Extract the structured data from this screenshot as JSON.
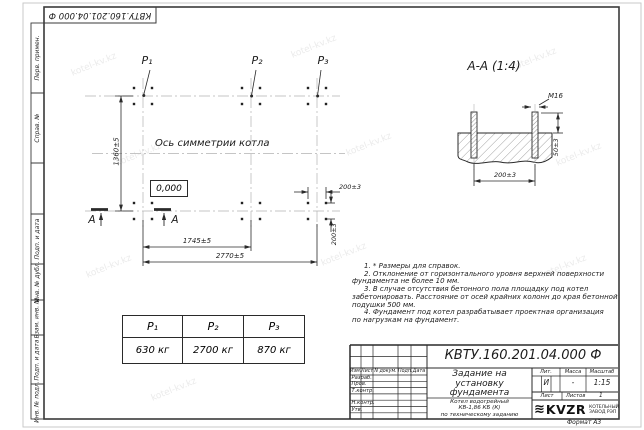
{
  "watermark": {
    "text": "kotel-kv.kz"
  },
  "corner_stamp": {
    "doc_number": "КВТУ.160.201.04.000 Ф"
  },
  "margin_fields": {
    "perv_primen": "Перв. примен.",
    "sprav_no": "Справ. №",
    "podp_data_1": "Подп. и дата",
    "inv_dubl": "Инв. № дубл.",
    "vzam_inv": "Взам. инв. №",
    "podp_data_2": "Подп. и дата",
    "inv_podl": "Инв. № подл."
  },
  "plan": {
    "load_labels": [
      "P₁",
      "P₂",
      "P₃"
    ],
    "symmetry_axis_label": "Ось симметрии котла",
    "elevation_mark": "0,000",
    "dim_height": "1360±5",
    "dim_span_p1_p2": "1745±5",
    "dim_span_total": "2770±5",
    "dim_bolt_spacing_h": "200±3",
    "dim_bolt_spacing_v": "200±3",
    "section_mark": "А"
  },
  "section": {
    "title": "А-А (1:4)",
    "bolt_thread": "M16",
    "dim_protrusion": "50±3",
    "dim_bolt_spacing": "200±3"
  },
  "loads_table": {
    "headers": [
      "P₁",
      "P₂",
      "P₃"
    ],
    "values": [
      "630 кг",
      "2700 кг",
      "870 кг"
    ]
  },
  "notes": {
    "lines": [
      "1. * Размеры для справок.",
      "2. Отклонение от горизонтального уровня верхней поверхности",
      "фундамента не более 10 мм.",
      "3. В случае отсутствия бетонного пола площадку под котел",
      "забетонировать. Расстояние от осей крайних колонн до края бетонной",
      "подушки 500 мм.",
      "4. Фундамент под котел разрабатывает проектная организация",
      "по нагрузкам на фундамент."
    ]
  },
  "title_block": {
    "doc_number": "КВТУ.160.201.04.000 Ф",
    "title_lines": [
      "Задание на",
      "установку",
      "фундамента"
    ],
    "product_lines": [
      "Котел водогрейный",
      "КВ-1,86 КБ (К)",
      "по техническому заданию"
    ],
    "rev_header": {
      "izm": "Изм.",
      "list": "Лист",
      "doc": "N докум.",
      "podp": "Подп.",
      "data": "Дата"
    },
    "staff_rows": [
      "Разраб.",
      "Пров.",
      "Т.контр.",
      "",
      "Н.контр.",
      "Утв."
    ],
    "lit_header": "Лит.",
    "mass_header": "Масса",
    "scale_header": "Масштаб",
    "lit_value": "И",
    "mass_value": "-",
    "scale_value": "1:15",
    "sheet_label": "Лист",
    "sheets_label": "Листов",
    "sheets_value": "1",
    "logo": {
      "name": "KVZR",
      "mark": "≋",
      "sub_lines": [
        "КОТЕЛЬНЫЙ",
        "ЗАВОД РЭП"
      ]
    },
    "format_label": "Формат А3"
  }
}
